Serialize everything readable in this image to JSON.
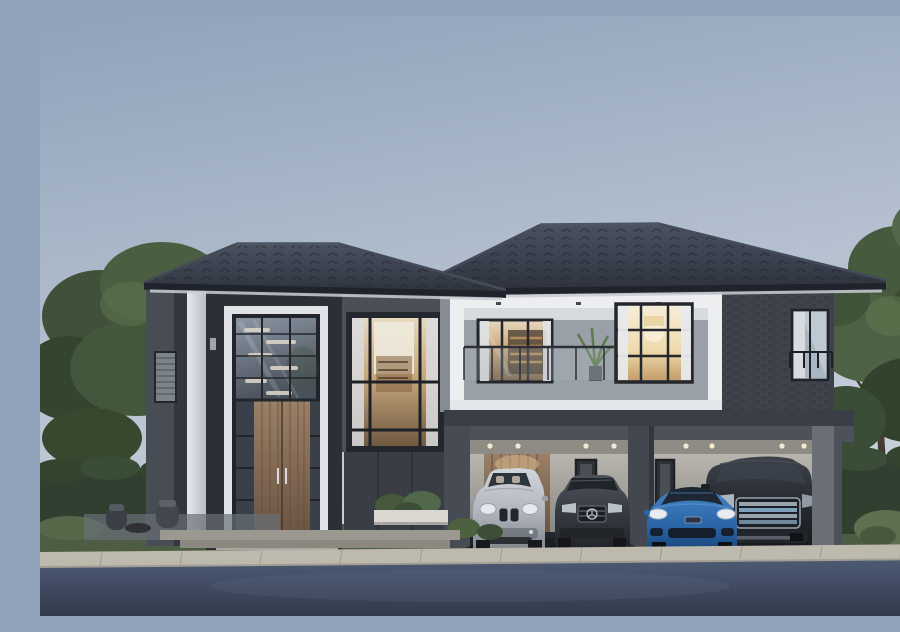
{
  "scene": {
    "type": "photorealistic architectural rendering",
    "subject": "Modern two-story luxury house at dusk with four cars parked under the carport",
    "time_of_day": "dusk",
    "weather": "clear",
    "text_visible": "none"
  },
  "house": {
    "style": "modern contemporary",
    "floors": 2,
    "features": [
      "dark charcoal hip tile roof",
      "double-height glass entrance tower with wooden double door",
      "decorative floating shelves visible through entrance glazing",
      "second-floor balcony with thin metal-glass railing and potted plant",
      "floor-to-ceiling windows with warm interior lighting and white curtains",
      "dark stone and brick cladding with white architectural trim",
      "two-bay carport with recessed ceiling downlights, wood accent wall and narrow slot windows"
    ]
  },
  "cars": [
    {
      "name": "silver-suv",
      "description": "silver luxury SUV with twin kidney grille",
      "color": "#c6cad0"
    },
    {
      "name": "gray-sedan",
      "description": "dark gray sedan with chrome emblem grille",
      "color": "#3c4046"
    },
    {
      "name": "blue-sports-sedan",
      "description": "blue low-slung sports sedan",
      "color": "#2a66a8"
    },
    {
      "name": "black-van",
      "description": "black luxury MPV van with chrome bar grille",
      "color": "#26292e"
    }
  ],
  "landscape": {
    "left": [
      "large leafy trees",
      "clipped hedge wall",
      "lawn",
      "wicker patio chairs with small table"
    ],
    "right": [
      "tall tree",
      "hedge wall",
      "round shrubs",
      "lawn"
    ],
    "front": [
      "white planter box with shrubs",
      "light stone steps and curb",
      "dark blue-gray asphalt driveway"
    ]
  },
  "palette": {
    "sky_top": "#8fa2ba",
    "sky_mid": "#b4c0cf",
    "sky_bottom": "#ccd5df",
    "roof_light": "#454c59",
    "roof_dark": "#2b303a",
    "roof_edge": "#1f232b",
    "soffit": "#c9ced4",
    "wall_gray": "#878c94",
    "wall_dark": "#43474f",
    "wall_stone": "#3a3d44",
    "brick": "#3f434b",
    "trim_white": "#eceef0",
    "frame_dark": "#24272d",
    "glass_cool": "#6e7884",
    "glass_warm": "#c8a87e",
    "glass_bright": "#f3e7c9",
    "wood_door": "#8a7058",
    "carport_wall": "#b4b1aa",
    "curb": "#bdb9ad",
    "step": "#9b988f",
    "asphalt_top": "#4d5a73",
    "asphalt_bottom": "#303a4b",
    "grass": "#57684c",
    "foliage_dark": "#33452f",
    "foliage_mid": "#42573b",
    "foliage_light": "#5d7450",
    "hedge": "#2f4031",
    "car_silver": "#c6cad0",
    "car_gray": "#3c4046",
    "car_blue": "#2a66a8",
    "car_black": "#26292e"
  }
}
